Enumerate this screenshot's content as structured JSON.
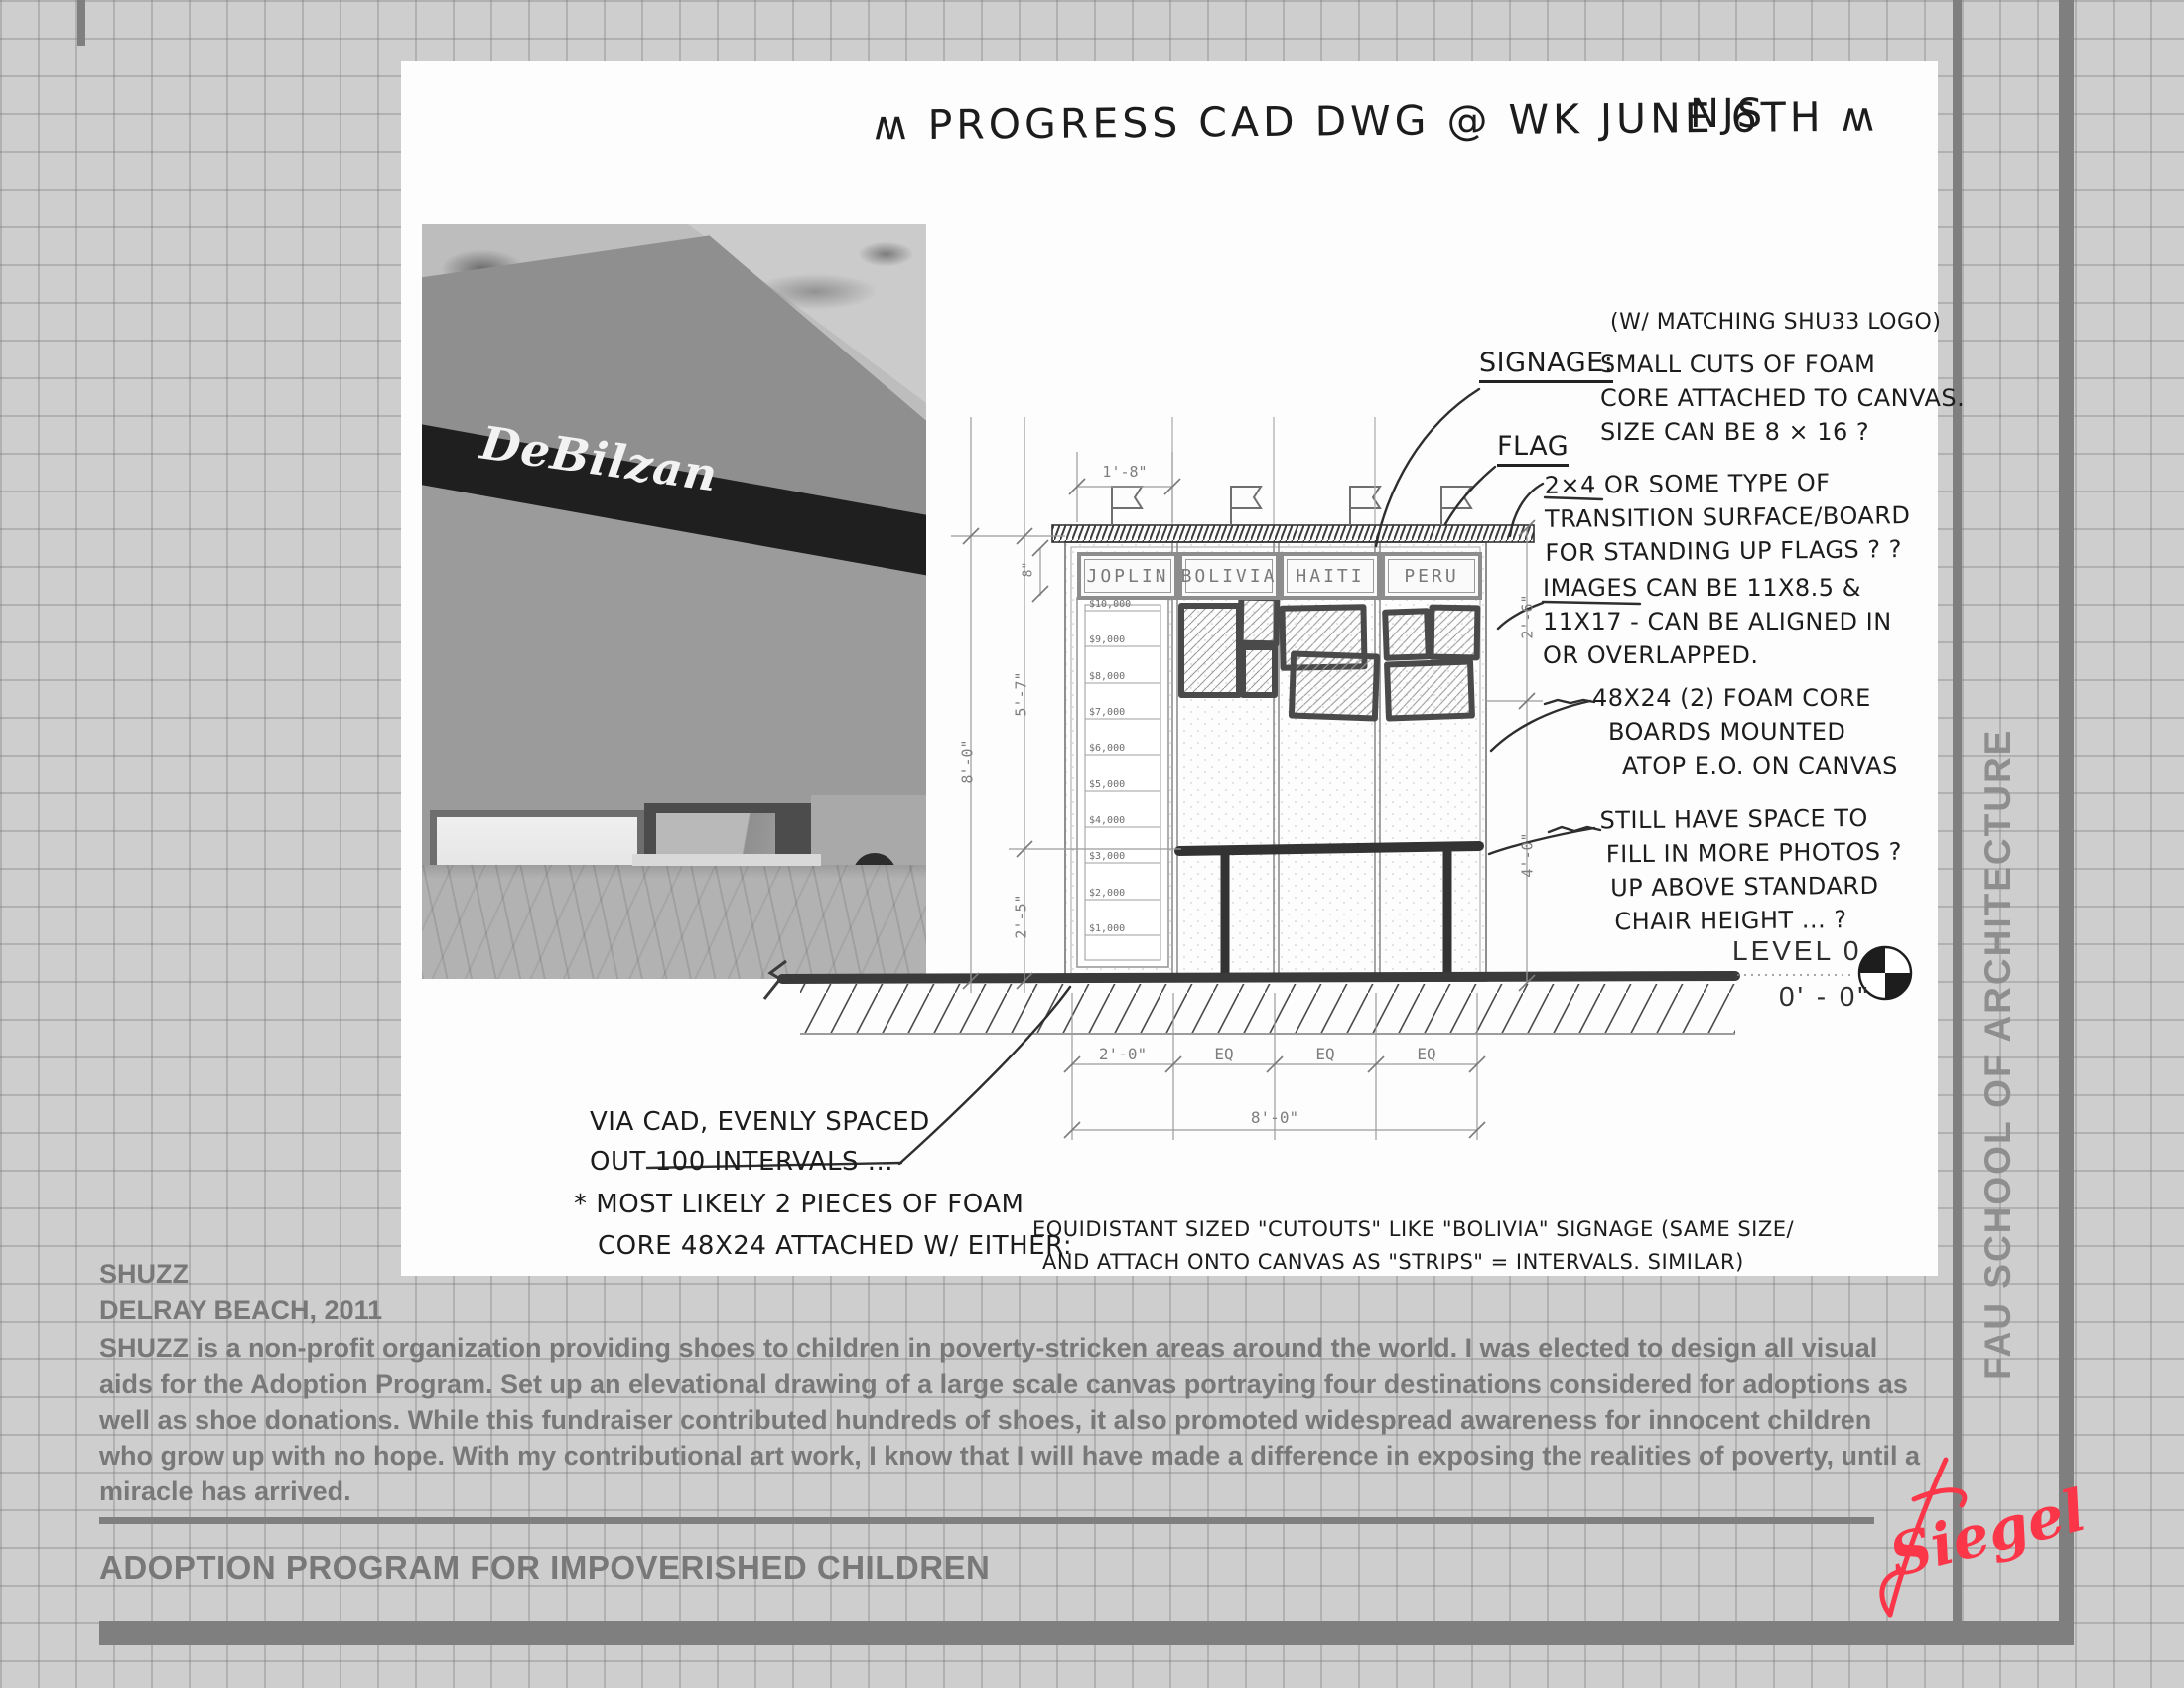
{
  "header": {
    "hand_title": "ʍ PROGRESS CAD DWG @ WK JUNE 6TH ʍ",
    "initials": "NJS"
  },
  "sidebar": {
    "label": "FAU SCHOOL OF ARCHITECTURE"
  },
  "photo": {
    "awning_text": "DeBilzan"
  },
  "drawing": {
    "signs": [
      "JOPLIN",
      "BOLIVIA",
      "HAITI",
      "PERU"
    ],
    "thermometer": [
      "$10,000",
      "$9,000",
      "$8,000",
      "$7,000",
      "$6,000",
      "$5,000",
      "$4,000",
      "$3,000",
      "$2,000",
      "$1,000"
    ],
    "dims": {
      "top": "1'-8\"",
      "sign_height": "8\"",
      "left_total": "8'-0\"",
      "left_upper": "5'-7\"",
      "left_lower": "2'-5\"",
      "right_upper": "2'-6\"",
      "right_lower": "4'-0\"",
      "bottom": [
        "2'-0\"",
        "EQ",
        "EQ",
        "EQ"
      ],
      "bottom_total": "8'-0\""
    },
    "level": {
      "label": "LEVEL 0",
      "value": "0' - 0\""
    }
  },
  "annotations": {
    "matching_logo": "(W/ MATCHING SHU33 LOGO)",
    "signage_label": "SIGNAGE:",
    "signage_body": [
      "SMALL CUTS OF FOAM",
      "CORE ATTACHED TO CANVAS.",
      "SIZE CAN BE 8 × 16 ?"
    ],
    "flag_label": "FLAG",
    "flags_note": [
      "2×4 OR SOME TYPE OF",
      "TRANSITION SURFACE/BOARD",
      "FOR STANDING UP  FLAGS ? ?"
    ],
    "images_note": [
      "IMAGES CAN BE 11X8.5 &",
      "11X17 - CAN BE ALIGNED IN",
      "OR OVERLAPPED."
    ],
    "foam_note": [
      "48X24 (2) FOAM CORE",
      "BOARDS MOUNTED",
      "ATOP E.O. ON CANVAS"
    ],
    "space_note": [
      "STILL HAVE SPACE TO",
      "FILL IN MORE PHOTOS ?",
      "UP ABOVE STANDARD",
      "CHAIR HEIGHT ... ?"
    ],
    "viacad_note": [
      "VIA CAD, EVENLY SPACED",
      "OUT  100 INTERVALS ..."
    ],
    "most_note": [
      "* MOST LIKELY 2 PIECES OF FOAM",
      "CORE 48X24 ATTACHED W/ EITHER:"
    ],
    "equi_note": [
      "EQUIDISTANT SIZED \"CUTOUTS\" LIKE \"BOLIVIA\" SIGNAGE (SAME SIZE/",
      "AND ATTACH ONTO CANVAS AS \"STRIPS\" = INTERVALS.    SIMILAR)"
    ]
  },
  "project": {
    "name": "SHUZZ",
    "location": "DELRAY BEACH, 2011",
    "description": "SHUZZ is a non-profit organization providing shoes to children in poverty-stricken areas around the world.  I was elected to design all visual aids for the Adoption Program.  Set up an elevational drawing of a large scale canvas portraying four destinations considered for adoptions as well as shoe donations.  While this fundraiser contributed hundreds of shoes, it also promoted widespread awareness for innocent children who grow up with no hope.  With my contributional art work, I know that I will have made a difference in exposing the realities of poverty, until a miracle has arrived.",
    "program_title": "ADOPTION PROGRAM FOR IMPOVERISHED CHILDREN",
    "signature": "Siegel"
  },
  "colors": {
    "signature_red": "#fb3648",
    "bar_gray": "#7f7f7f",
    "text_gray": "#787878"
  }
}
